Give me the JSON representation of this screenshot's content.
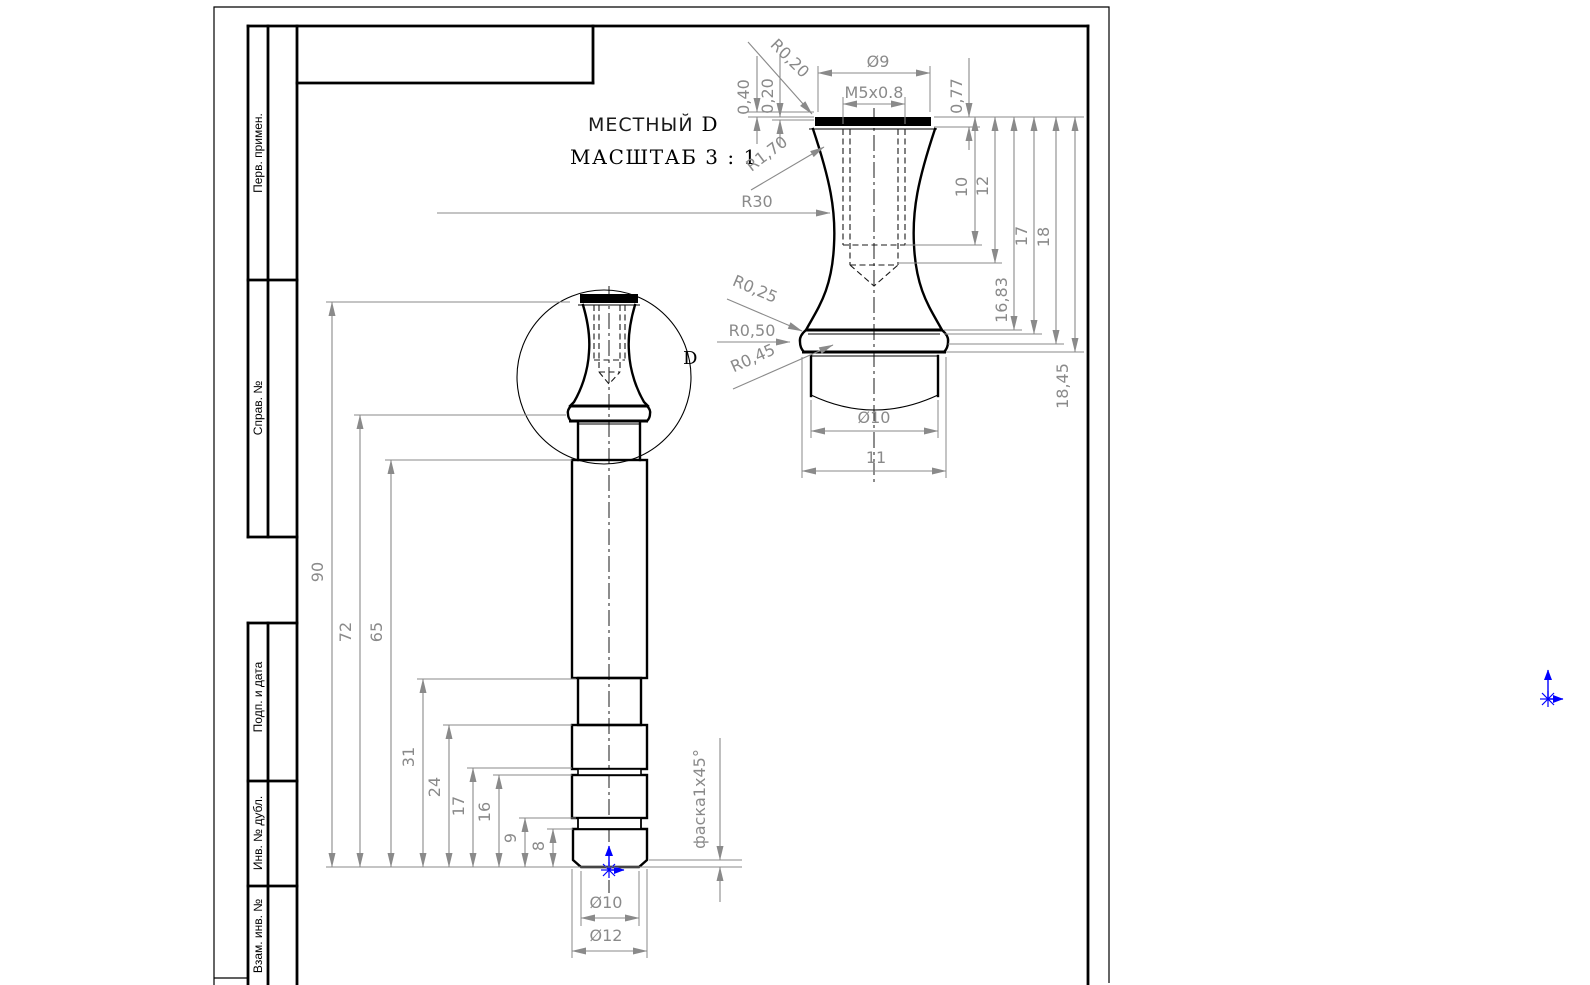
{
  "sheet": {
    "stamps": [
      {
        "label": "Перв. примен."
      },
      {
        "label": "Справ. №"
      },
      {
        "label": "Подп. и дата"
      },
      {
        "label": "Инв. № дубл."
      },
      {
        "label": "Взам. инв. №"
      }
    ]
  },
  "detail_view": {
    "title_word": "МЕСТНЫЙ",
    "title_letter": "D",
    "scale_label": "МАСШТАБ 3 : 1",
    "dims": {
      "r0_20": "R0,20",
      "dia9": "Ø9",
      "thread": "M5x0.8",
      "t0_77": "0,77",
      "t0_40": "0,40",
      "t0_20": "0,20",
      "r1_70": "R1,70",
      "r30": "R30",
      "len10": "10",
      "len12": "12",
      "len16_83": "16,83",
      "len17": "17",
      "len18": "18",
      "len18_45": "18,45",
      "r0_25": "R0,25",
      "r0_50": "R0,50",
      "r0_45": "R0,45",
      "dia10": "Ø10",
      "len11": "11"
    }
  },
  "main_view": {
    "detail_mark": "D",
    "dims": {
      "len90": "90",
      "len72": "72",
      "len65": "65",
      "len31": "31",
      "len24": "24",
      "len17": "17",
      "len16": "16",
      "len9": "9",
      "len8": "8",
      "dia10": "Ø10",
      "dia12": "Ø12",
      "chamfer": "фаска1x45°"
    }
  },
  "colors": {
    "dim_gray": "#8a8a8a",
    "line_black": "#000000",
    "origin_blue": "#0000ff",
    "hatch_gray": "#b5b5b5",
    "background": "#ffffff"
  }
}
